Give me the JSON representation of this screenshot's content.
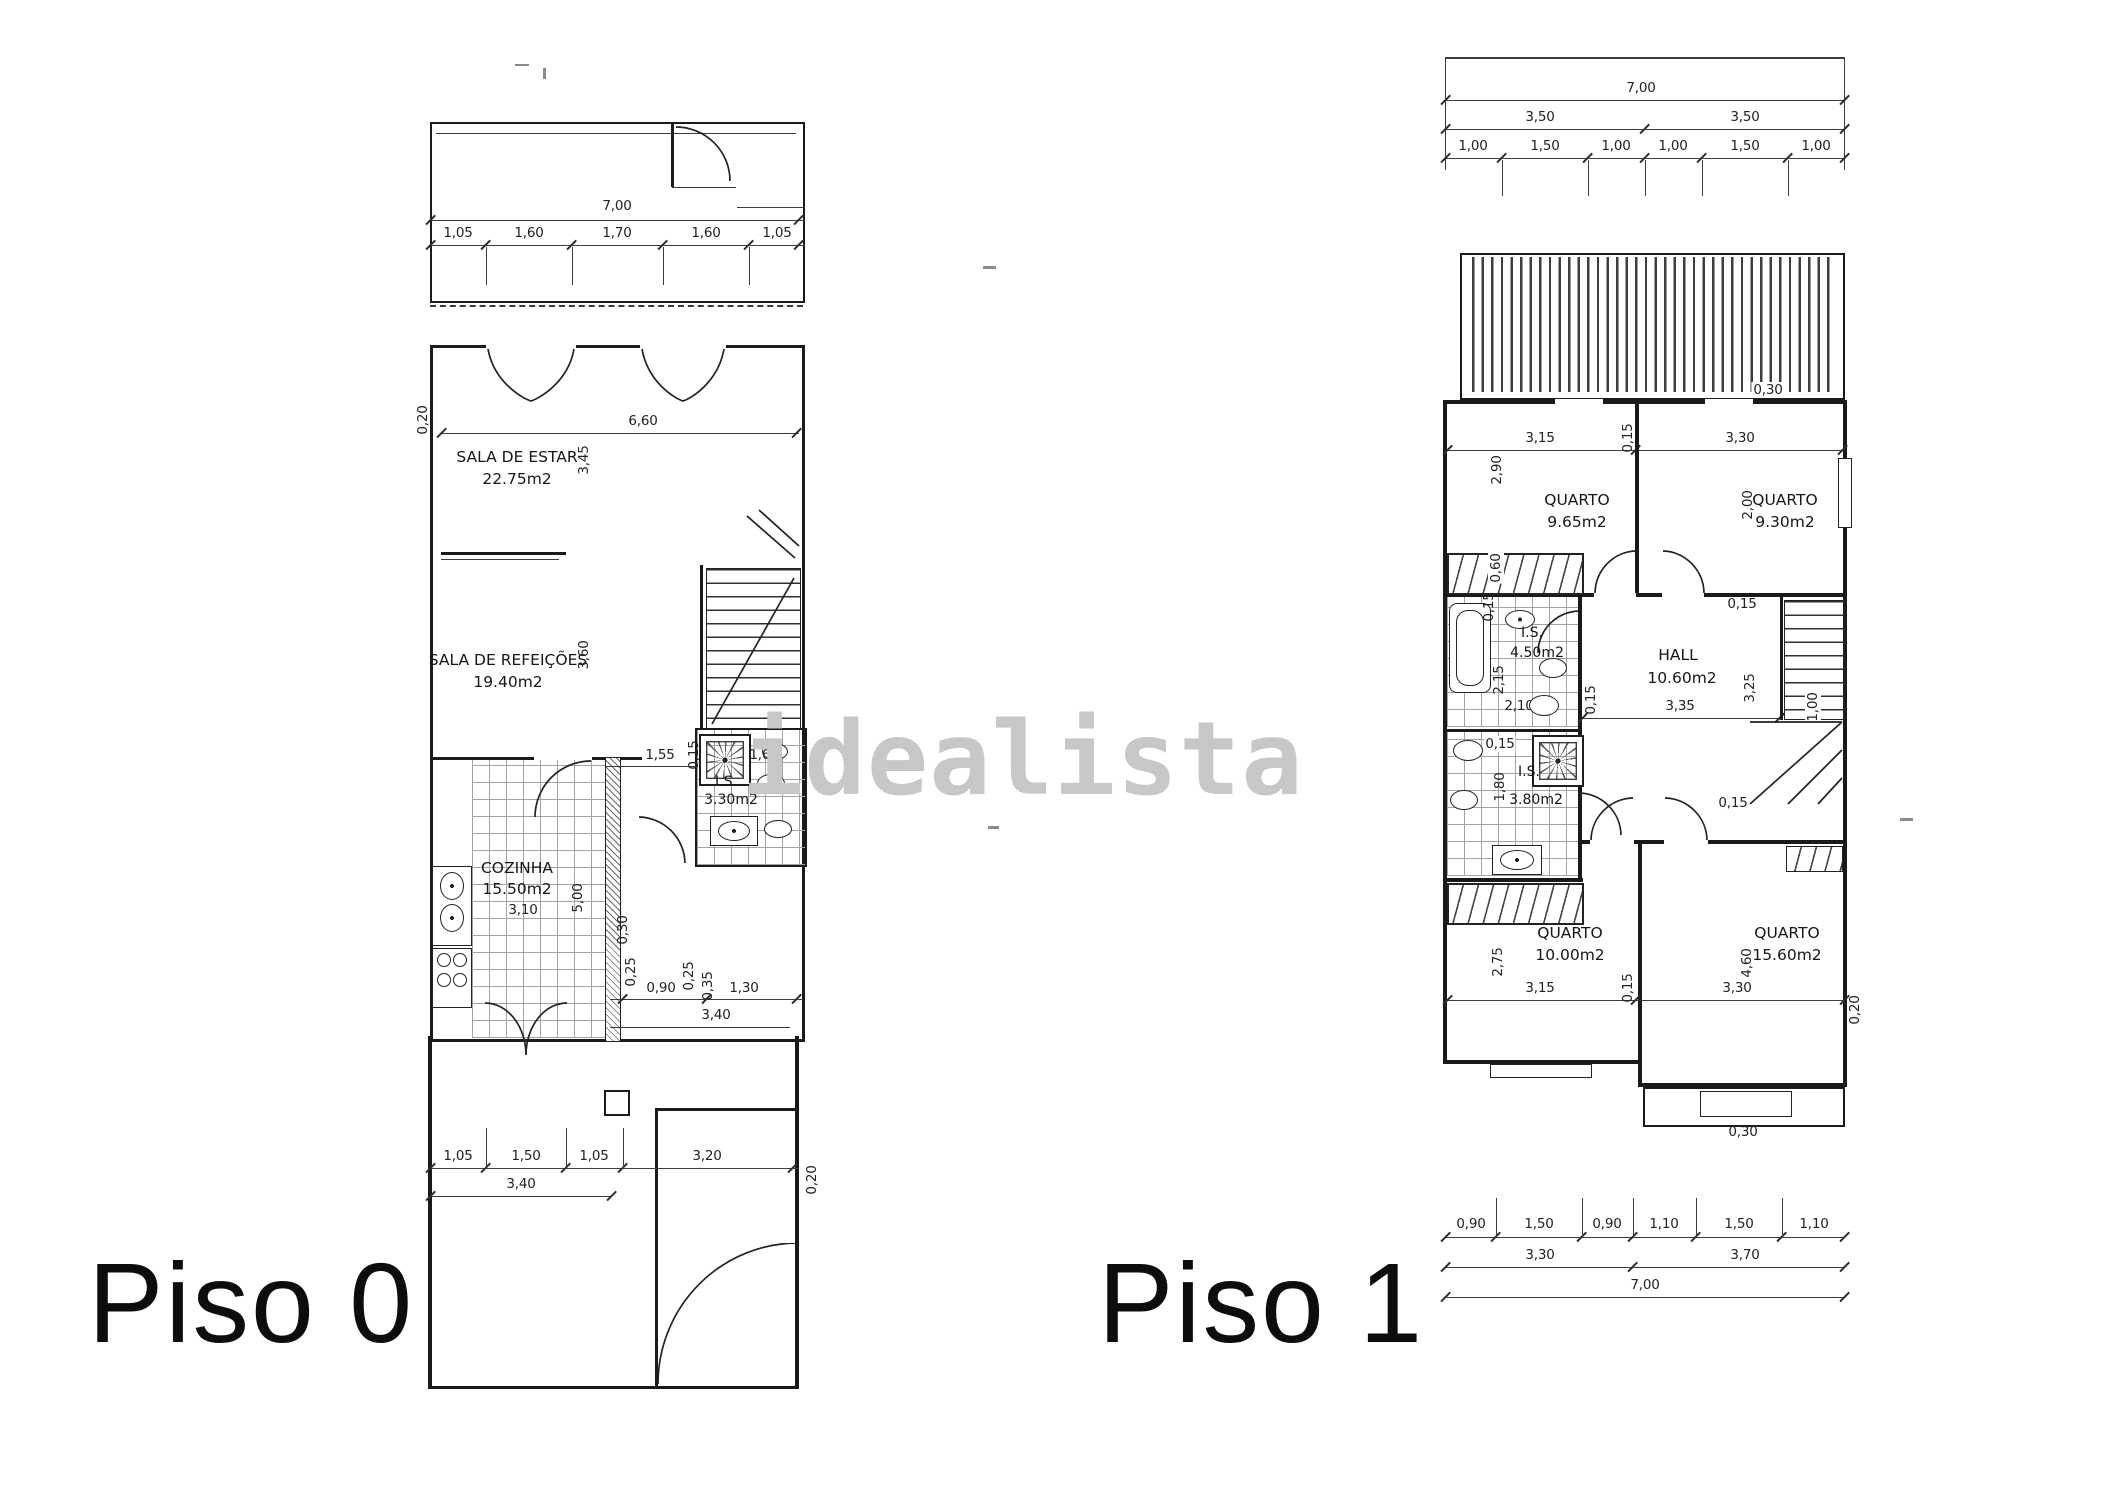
{
  "watermark": {
    "text": "idealista"
  },
  "floor0": {
    "title": "Piso 0",
    "rooms": {
      "estar": {
        "name": "SALA DE ESTAR",
        "area": "22.75m2"
      },
      "refeicoes": {
        "name": "SALA DE REFEIÇÕES",
        "area": "19.40m2"
      },
      "cozinha": {
        "name": "COZINHA",
        "area": "15.50m2"
      },
      "is": {
        "name": "I.S.",
        "area": "3.30m2"
      }
    },
    "dims": {
      "total": "7,00",
      "top": [
        "1,05",
        "1,60",
        "1,70",
        "1,60",
        "1,05"
      ],
      "inner_width": "6,60",
      "wall": "0,20",
      "estar_h": "3,45",
      "refeicoes_h": "3,60",
      "cozinha_w": "3,10",
      "cozinha_h": "5,00",
      "is_row": [
        "1,55",
        "0,15",
        "1,65"
      ],
      "low_row": [
        "0,30",
        "0,25",
        "0,90",
        "0,25",
        "0,35",
        "1,30"
      ],
      "low_sub": "3,40",
      "bottom": [
        "1,05",
        "1,50",
        "1,05"
      ],
      "bottom_sub": "3,40",
      "bottom_right": "3,20",
      "wall_r": "0,20"
    }
  },
  "floor1": {
    "title": "Piso 1",
    "rooms": {
      "q1": {
        "name": "QUARTO",
        "area": "9.65m2"
      },
      "q2": {
        "name": "QUARTO",
        "area": "9.30m2"
      },
      "is1": {
        "name": "I.S.",
        "area": "4.50m2"
      },
      "hall": {
        "name": "HALL",
        "area": "10.60m2"
      },
      "is2": {
        "name": "I.S.",
        "area": "3.80m2"
      },
      "q3": {
        "name": "QUARTO",
        "area": "10.00m2"
      },
      "q4": {
        "name": "QUARTO",
        "area": "15.60m2"
      }
    },
    "dims": {
      "total_top": "7,00",
      "halves_top": [
        "3,50",
        "3,50"
      ],
      "top": [
        "1,00",
        "1,50",
        "1,00",
        "1,00",
        "1,50",
        "1,00"
      ],
      "balcony_top": "0,30",
      "up_row": [
        "3,15",
        "0,15",
        "3,30"
      ],
      "q1_h": "2,90",
      "q2_h": "2,00",
      "ward_up": "0,60",
      "is1_top": "0,15",
      "is1_h": "2,15",
      "is1_w": "2,10",
      "is1_side": "0,15",
      "hall_top": "0,15",
      "hall_w": "3,35",
      "hall_h": "3,25",
      "stair_w": "1,00",
      "is2_top": "0,15",
      "is2_h": "1,80",
      "is2_bottom": "0,15",
      "q4_top": "0,15",
      "low_row": [
        "3,15",
        "0,15",
        "3,30"
      ],
      "q3_h": "2,75",
      "q4_h": "4,60",
      "wall_r": "0,20",
      "balcony_bottom": "0,30",
      "bottom": [
        "0,90",
        "1,50",
        "0,90",
        "1,10",
        "1,50",
        "1,10"
      ],
      "halves_bottom": [
        "3,30",
        "3,70"
      ],
      "total_bottom": "7,00"
    }
  }
}
